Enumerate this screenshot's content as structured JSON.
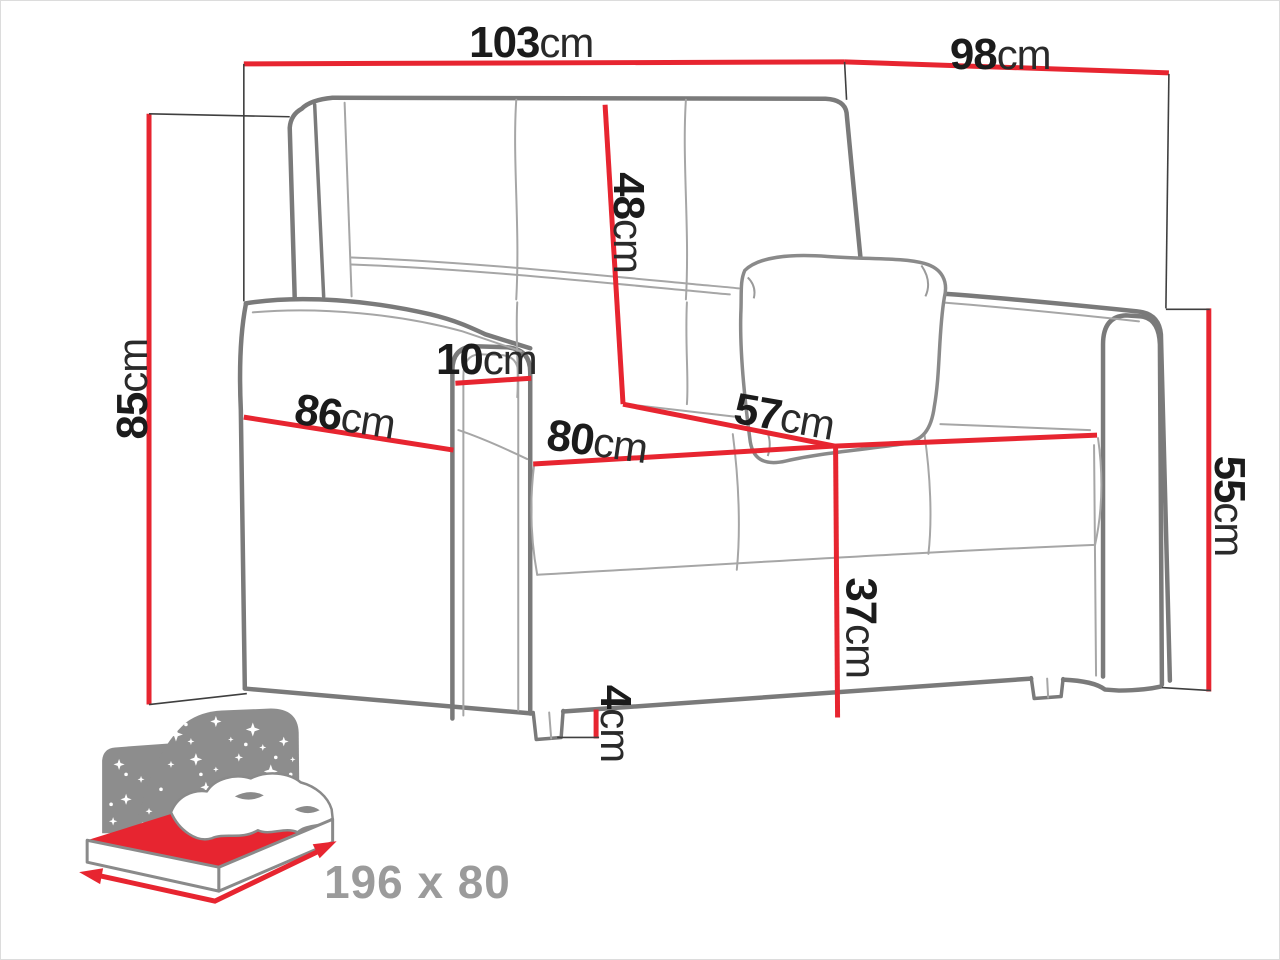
{
  "colors": {
    "dimension_red": "#e72530",
    "outline_gray": "#7a7a7a",
    "seam_gray": "#a6a6a6",
    "extension_black": "#3f3f3f",
    "icon_gray": "#8d8d8d",
    "bed_label_gray": "#9b9b9b"
  },
  "unit": "cm",
  "dims": {
    "back_width": {
      "value": "103",
      "unit": "cm"
    },
    "top_depth": {
      "value": "98",
      "unit": "cm"
    },
    "total_height": {
      "value": "85",
      "unit": "cm"
    },
    "backrest_height": {
      "value": "48",
      "unit": "cm"
    },
    "armrest_width": {
      "value": "10",
      "unit": "cm"
    },
    "side_depth": {
      "value": "86",
      "unit": "cm"
    },
    "seat_width": {
      "value": "80",
      "unit": "cm"
    },
    "seat_depth": {
      "value": "57",
      "unit": "cm"
    },
    "armrest_height": {
      "value": "55",
      "unit": "cm"
    },
    "seat_height": {
      "value": "37",
      "unit": "cm"
    },
    "leg_height": {
      "value": "4",
      "unit": "cm"
    }
  },
  "sleeping_area": {
    "size_label": "196 x 80"
  }
}
